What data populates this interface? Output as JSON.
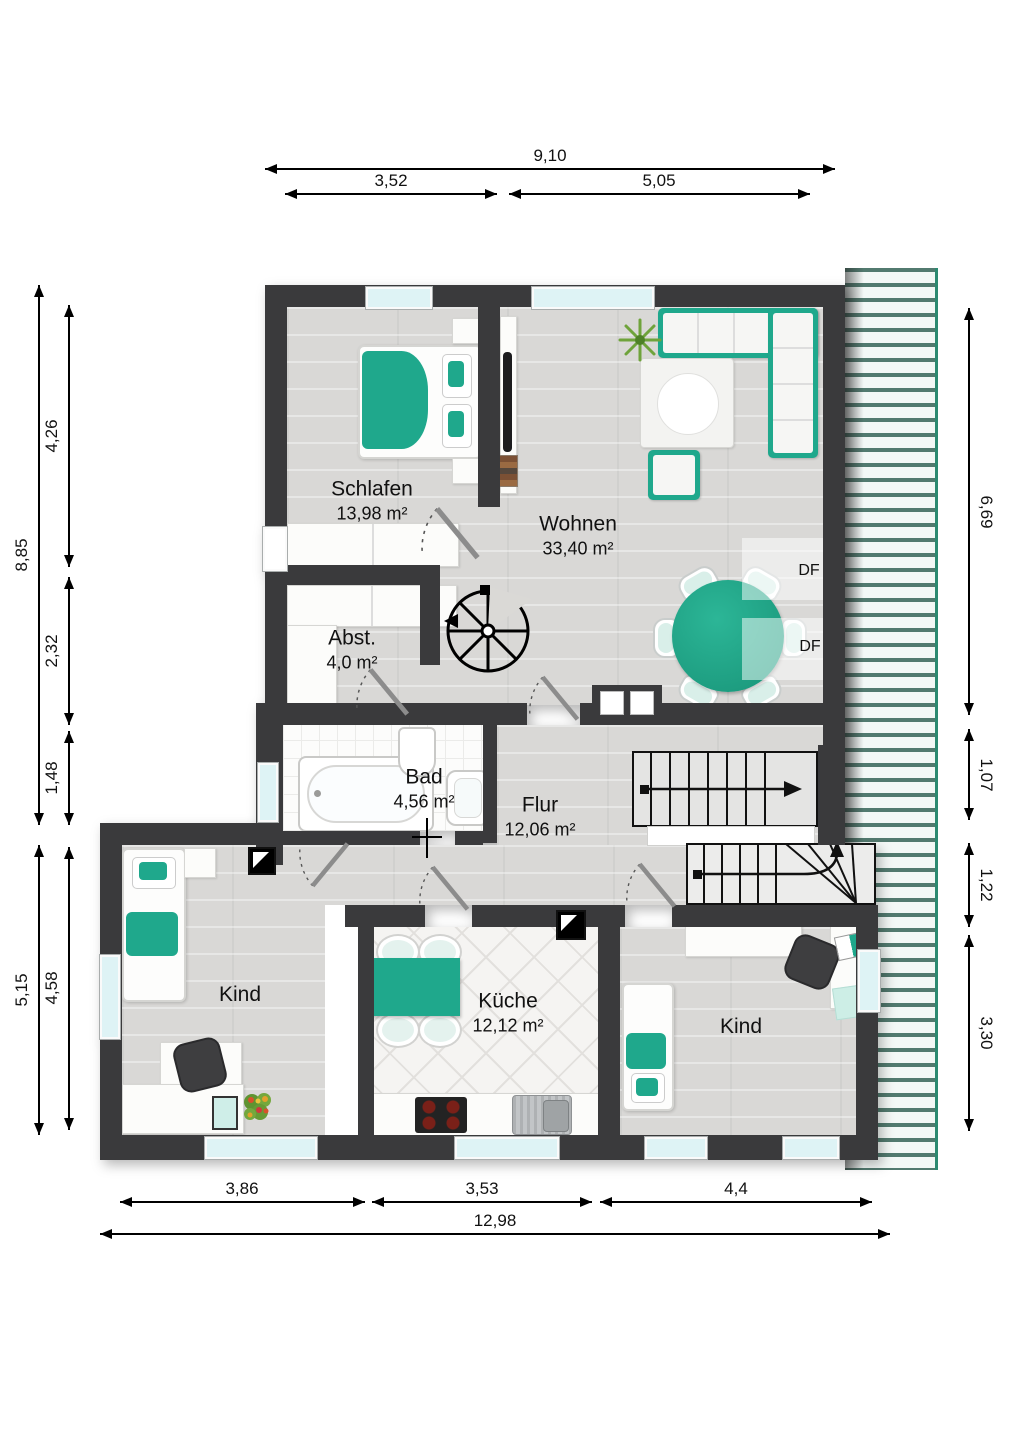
{
  "plan": {
    "rooms": [
      {
        "name": "Schlafen",
        "area": "13,98 m²"
      },
      {
        "name": "Wohnen",
        "area": "33,40 m²"
      },
      {
        "name": "Abst.",
        "area": "4,0 m²"
      },
      {
        "name": "Bad",
        "area": "4,56 m²"
      },
      {
        "name": "Flur",
        "area": "12,06 m²"
      },
      {
        "name": "Kind",
        "area": ""
      },
      {
        "name": "Küche",
        "area": "12,12 m²"
      },
      {
        "name": "Kind",
        "area": ""
      }
    ],
    "roof_window_label": "DF",
    "colors": {
      "wall": "#3a3a3c",
      "accent_teal": "#1fa88c",
      "floor_wood": "#d9d8d6",
      "window_glass": "#def3f5",
      "roof_hatch_green": "#527a6f"
    }
  },
  "dimensions": {
    "top": [
      {
        "label": "9,10"
      },
      {
        "label": "3,52"
      },
      {
        "label": "5,05"
      }
    ],
    "bottom": [
      {
        "label": "3,86"
      },
      {
        "label": "3,53"
      },
      {
        "label": "4,4"
      },
      {
        "label": "12,98"
      }
    ],
    "left": [
      {
        "label": "8,85"
      },
      {
        "label": "4,26"
      },
      {
        "label": "2,32"
      },
      {
        "label": "1,48"
      },
      {
        "label": "5,15"
      },
      {
        "label": "4,58"
      }
    ],
    "right": [
      {
        "label": "6,69"
      },
      {
        "label": "1,07"
      },
      {
        "label": "1,22"
      },
      {
        "label": "3,30"
      }
    ]
  }
}
